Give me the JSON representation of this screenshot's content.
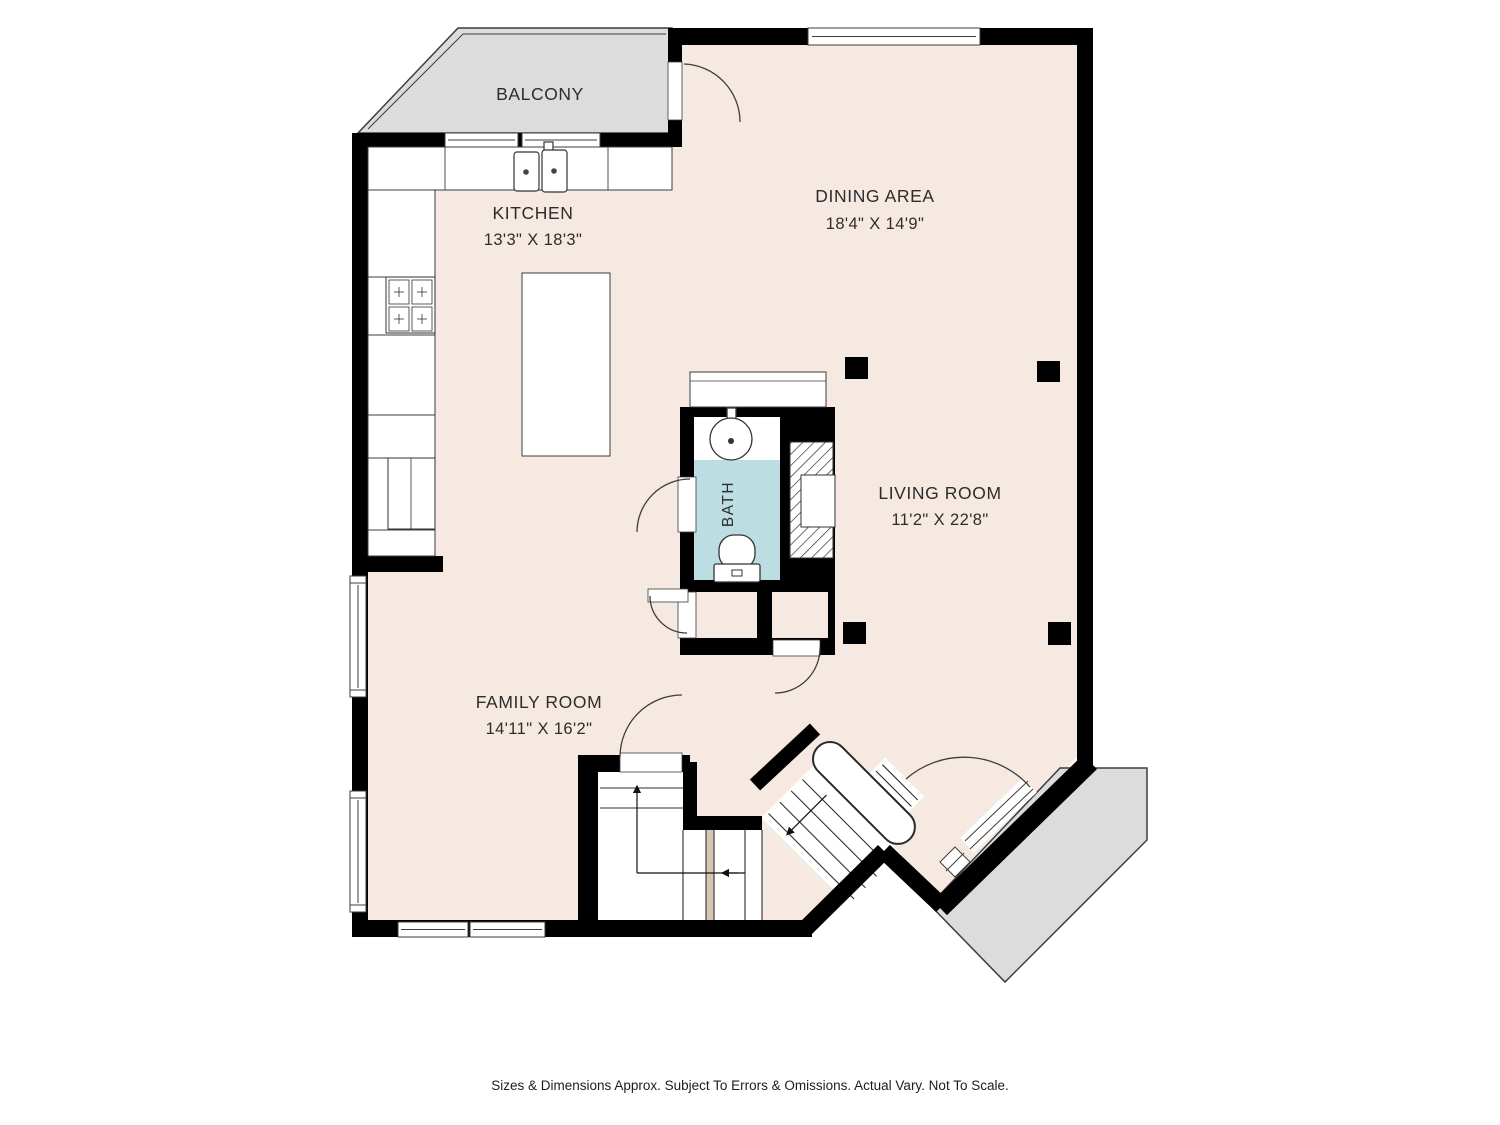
{
  "document": {
    "type": "floor-plan",
    "background": "#ffffff"
  },
  "colors": {
    "floor": "#f5e9e2",
    "outdoor_gray": "#dcdcdc",
    "bath_floor": "#bcdde2",
    "wall": "#000000",
    "thin_line": "#3d3d3d",
    "stair_accent": "#d6c6b2",
    "text": "#2d2d2d"
  },
  "rooms": {
    "balcony": {
      "name": "BALCONY"
    },
    "kitchen": {
      "name": "KITCHEN",
      "dims": "13'3\" X 18'3\""
    },
    "dining": {
      "name": "DINING AREA",
      "dims": "18'4\" X 14'9\""
    },
    "living": {
      "name": "LIVING ROOM",
      "dims": "11'2\" X 22'8\""
    },
    "family": {
      "name": "FAMILY ROOM",
      "dims": "14'11\" X 16'2\""
    },
    "bath": {
      "name": "BATH"
    }
  },
  "fixtures": [
    "kitchen-sink",
    "stove",
    "refrigerator",
    "kitchen-island",
    "bath-sink",
    "toilet",
    "fireplace",
    "staircase",
    "deck",
    "balcony"
  ],
  "footer": {
    "disclaimer": "Sizes & Dimensions Approx. Subject To Errors & Omissions. Actual Vary. Not To Scale."
  }
}
